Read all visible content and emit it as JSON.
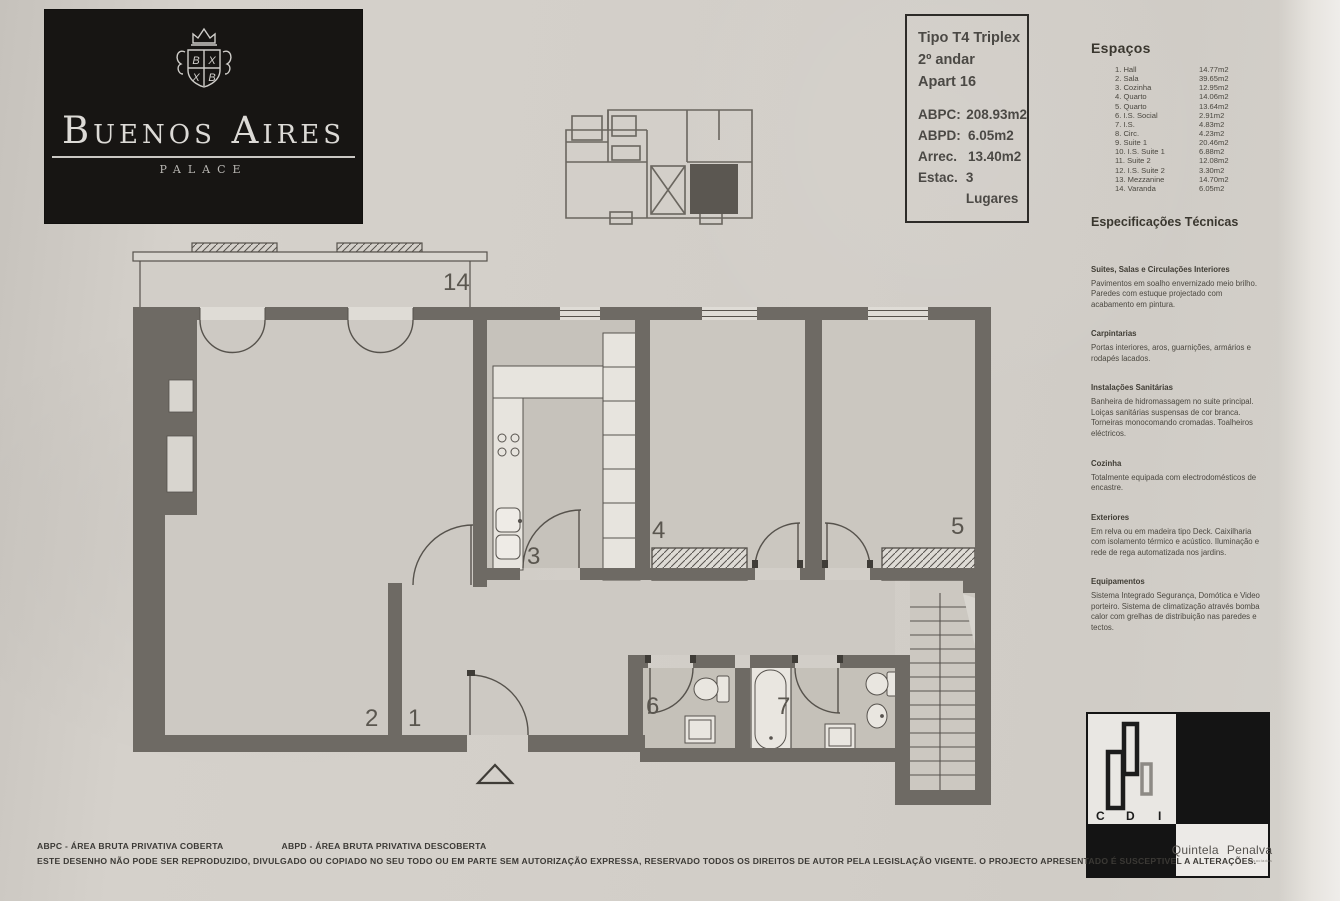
{
  "logo": {
    "title": "Buenos Aires",
    "subtitle": "PALACE",
    "crest": {
      "q1": "B",
      "q2": "X",
      "q3": "X",
      "q4": "B"
    }
  },
  "key_plan": {
    "name": "building key plan"
  },
  "info_box": {
    "line1": "Tipo T4 Triplex",
    "line2": "2º andar",
    "line3": "Apart 16",
    "metrics": [
      {
        "label": "ABPC:",
        "value": "208.93m2"
      },
      {
        "label": "ABPD:",
        "value": "6.05m2"
      },
      {
        "label": "Arrec.",
        "value": "13.40m2"
      },
      {
        "label": "Estac.",
        "value": "3 Lugares"
      }
    ]
  },
  "espacos": {
    "title": "Espaços",
    "items": [
      {
        "label": "1. Hall",
        "area": "14.77m2"
      },
      {
        "label": "2. Sala",
        "area": "39.65m2"
      },
      {
        "label": "3. Cozinha",
        "area": "12.95m2"
      },
      {
        "label": "4. Quarto",
        "area": "14.06m2"
      },
      {
        "label": "5. Quarto",
        "area": "13.64m2"
      },
      {
        "label": "6. I.S. Social",
        "area": "2.91m2"
      },
      {
        "label": "7. I.S.",
        "area": "4.83m2"
      },
      {
        "label": "8. Circ.",
        "area": "4.23m2"
      },
      {
        "label": "9. Suite 1",
        "area": "20.46m2"
      },
      {
        "label": "10. I.S. Suite 1",
        "area": "6.88m2"
      },
      {
        "label": "11. Suite 2",
        "area": "12.08m2"
      },
      {
        "label": "12. I.S. Suite 2",
        "area": "3.30m2"
      },
      {
        "label": "13. Mezzanine",
        "area": "14.70m2"
      },
      {
        "label": "14. Varanda",
        "area": "6.05m2"
      }
    ]
  },
  "specs": {
    "title": "Especificações Técnicas",
    "sections": [
      {
        "heading": "Suites, Salas e Circulações Interiores",
        "body": "Pavimentos em soalho envernizado meio brilho. Paredes com estuque projectado com acabamento em pintura."
      },
      {
        "heading": "Carpintarias",
        "body": "Portas interiores, aros, guarnições, armários e rodapés lacados."
      },
      {
        "heading": "Instalações Sanitárias",
        "body": "Banheira de hidromassagem no suite principal. Loiças sanitárias suspensas de cor branca. Torneiras monocomando cromadas. Toalheiros eléctricos."
      },
      {
        "heading": "Cozinha",
        "body": "Totalmente equipada com electrodomésticos de encastre."
      },
      {
        "heading": "Exteriores",
        "body": "Em relva ou em madeira tipo Deck. Caixilharia com isolamento térmico e acústico. Iluminação e rede de rega automatizada nos jardins."
      },
      {
        "heading": "Equipamentos",
        "body": "Sistema Integrado Segurança, Domótica e Video porteiro. Sistema de climatização através bomba calor com grelhas de distribuição nas paredes e tectos."
      }
    ]
  },
  "plan": {
    "labels": {
      "varanda": "14",
      "sala": "2",
      "hall": "1",
      "cozinha": "3",
      "quarto4": "4",
      "quarto5": "5",
      "is6": "6",
      "is7": "7"
    },
    "colors": {
      "wall": "#6e6a64",
      "line": "#56524c",
      "floor": "#cdc9c3",
      "wet_floor": "#c6c2bb"
    }
  },
  "brand_block": {
    "cdi": {
      "c": "C",
      "d": "D",
      "i": "I"
    },
    "quintela": "Quintela",
    "penalva": "Penalva",
    "sub": "Associados"
  },
  "footer": {
    "legend_abpc": "ABPC - ÁREA BRUTA PRIVATIVA COBERTA",
    "legend_abpd": "ABPD - ÁREA BRUTA PRIVATIVA DESCOBERTA",
    "disclaimer": "ESTE DESENHO NÃO PODE SER REPRODUZIDO, DIVULGADO OU COPIADO NO SEU TODO OU EM PARTE SEM AUTORIZAÇÃO EXPRESSA, RESERVADO TODOS OS DIREITOS DE AUTOR PELA LEGISLAÇÃO VIGENTE. O PROJECTO APRESENTADO É SUSCEPTIVEL A ALTERAÇÕES."
  }
}
